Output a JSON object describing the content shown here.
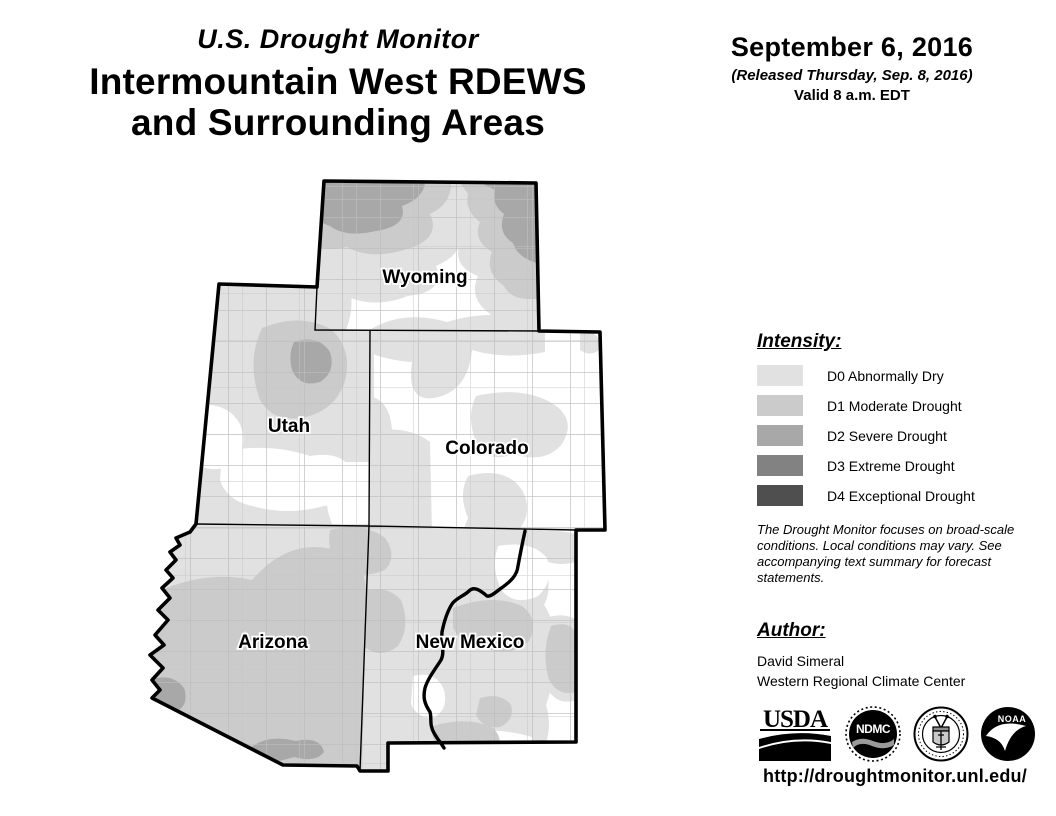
{
  "header": {
    "kicker": "U.S. Drought Monitor",
    "title_line1": "Intermountain West RDEWS",
    "title_line2": "and Surrounding Areas"
  },
  "date_block": {
    "date": "September 6, 2016",
    "released": "(Released Thursday, Sep. 8, 2016)",
    "valid": "Valid 8 a.m. EDT"
  },
  "map": {
    "state_labels": [
      {
        "text": "Wyoming"
      },
      {
        "text": "Utah"
      },
      {
        "text": "Colorado"
      },
      {
        "text": "Arizona"
      },
      {
        "text": "New Mexico"
      }
    ]
  },
  "legend": {
    "heading": "Intensity:",
    "items": [
      {
        "code": "D0",
        "label": "D0 Abnormally Dry",
        "color": "#e1e1e1"
      },
      {
        "code": "D1",
        "label": "D1 Moderate Drought",
        "color": "#cbcbcb"
      },
      {
        "code": "D2",
        "label": "D2 Severe Drought",
        "color": "#a8a8a8"
      },
      {
        "code": "D3",
        "label": "D3 Extreme Drought",
        "color": "#828282"
      },
      {
        "code": "D4",
        "label": "D4 Exceptional Drought",
        "color": "#4f4f4f"
      }
    ]
  },
  "disclaimer": "The Drought Monitor focuses on broad-scale conditions. Local conditions may vary. See accompanying text summary for forecast statements.",
  "author": {
    "heading": "Author:",
    "name": "David Simeral",
    "org": "Western Regional Climate Center"
  },
  "logos": [
    {
      "name": "USDA",
      "text": "USDA"
    },
    {
      "name": "NDMC",
      "text": "NDMC"
    },
    {
      "name": "Department of Commerce",
      "text": ""
    },
    {
      "name": "NOAA",
      "text": "NOAA"
    }
  ],
  "footer": {
    "url": "http://droughtmonitor.unl.edu/"
  }
}
